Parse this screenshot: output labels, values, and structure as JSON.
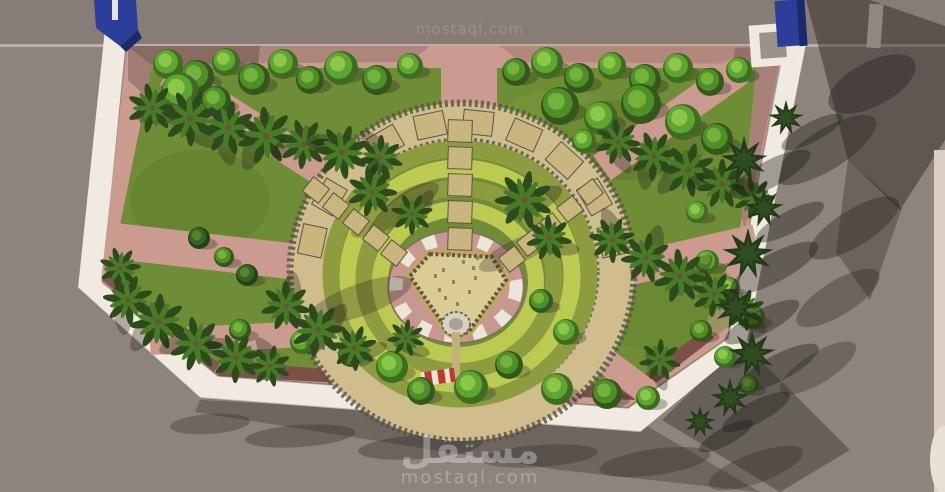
{
  "watermark": {
    "top": "mostaql.com",
    "logo_ar": "مستقل",
    "url": "mostaql.com"
  },
  "palette": {
    "street": "#8e847d",
    "streetTop": "#887d76",
    "shadow": "#27221e",
    "wall": "#f0eae2",
    "wallShade": "#d9d1c6",
    "paving": "#cb9b8f",
    "pavingShade": "#b2857c",
    "maroon": "#7c5047",
    "lawn": "#6f8c36",
    "lawnShade": "#5a7629",
    "ringTan": "#cfbd8e",
    "pebble": "#56504a",
    "grassLight": "#bcca52",
    "grassOlive": "#8c9c3e",
    "plaza": "#c69890",
    "checker": "#ece5da",
    "shield": "#dbcc96",
    "shieldGold": "#c3a65c",
    "shieldDark": "#5f564a",
    "paver": "#c9b67e",
    "paverEdge": "#5b5348",
    "fountain": "#d8d2c6",
    "tanPath": "#c4b07a",
    "blue": "#2c3e99",
    "blueDark": "#1d2a6a",
    "cream": "#d9cec1",
    "creamLight": "#e9e1d5",
    "red": "#c0392b",
    "white": "#ffffff",
    "palmDark": "#2c4a1b",
    "palmLight": "#4a7a26",
    "palmTrunk": "#6b5436",
    "conifer": "#233a1a",
    "coniferLight": "#2f4d20"
  },
  "scene": {
    "center": {
      "x": 462,
      "y": 272
    },
    "treeColors": [
      [
        "#3f6b22",
        "#5ea62f",
        "#8cc74b"
      ],
      [
        "#35571d",
        "#4f8f28",
        "#74b23c"
      ],
      [
        "#24411c",
        "#38631f",
        "#52862c"
      ]
    ],
    "trees": [
      [
        168,
        64,
        15,
        0
      ],
      [
        197,
        77,
        17,
        1
      ],
      [
        226,
        62,
        14,
        0
      ],
      [
        254,
        79,
        16,
        1
      ],
      [
        283,
        64,
        15,
        0
      ],
      [
        310,
        80,
        14,
        1
      ],
      [
        341,
        68,
        17,
        0
      ],
      [
        377,
        80,
        15,
        1
      ],
      [
        410,
        66,
        13,
        0
      ],
      [
        516,
        72,
        14,
        1
      ],
      [
        547,
        63,
        16,
        0
      ],
      [
        579,
        78,
        15,
        1
      ],
      [
        612,
        66,
        14,
        0
      ],
      [
        645,
        80,
        16,
        1
      ],
      [
        678,
        68,
        15,
        0
      ],
      [
        710,
        82,
        14,
        1
      ],
      [
        739,
        70,
        13,
        0
      ],
      [
        180,
        92,
        19,
        0
      ],
      [
        216,
        101,
        15,
        1
      ],
      [
        560,
        106,
        19,
        1
      ],
      [
        601,
        118,
        17,
        0
      ],
      [
        641,
        104,
        20,
        1
      ],
      [
        683,
        122,
        18,
        0
      ],
      [
        717,
        139,
        16,
        1
      ],
      [
        584,
        141,
        12,
        0
      ],
      [
        199,
        238,
        11,
        2
      ],
      [
        224,
        257,
        10,
        1
      ],
      [
        247,
        275,
        11,
        2
      ],
      [
        697,
        212,
        11,
        0
      ],
      [
        707,
        262,
        12,
        0
      ],
      [
        729,
        288,
        11,
        0
      ],
      [
        753,
        317,
        12,
        0
      ],
      [
        701,
        331,
        11,
        1
      ],
      [
        725,
        357,
        11,
        0
      ],
      [
        749,
        385,
        10,
        1
      ],
      [
        240,
        330,
        11,
        1
      ],
      [
        302,
        342,
        12,
        0
      ],
      [
        351,
        354,
        13,
        1
      ],
      [
        392,
        367,
        16,
        0
      ],
      [
        421,
        391,
        14,
        1
      ],
      [
        471,
        387,
        17,
        0
      ],
      [
        509,
        365,
        14,
        1
      ],
      [
        557,
        389,
        16,
        0
      ],
      [
        607,
        394,
        15,
        1
      ],
      [
        648,
        398,
        12,
        0
      ],
      [
        541,
        301,
        12,
        1
      ],
      [
        566,
        332,
        13,
        0
      ]
    ],
    "palms": [
      [
        152,
        108,
        24
      ],
      [
        190,
        118,
        27
      ],
      [
        228,
        128,
        26
      ],
      [
        266,
        136,
        28
      ],
      [
        304,
        144,
        24
      ],
      [
        342,
        152,
        26
      ],
      [
        380,
        158,
        22
      ],
      [
        372,
        192,
        24
      ],
      [
        412,
        214,
        20
      ],
      [
        524,
        200,
        28
      ],
      [
        549,
        238,
        22
      ],
      [
        120,
        268,
        20
      ],
      [
        128,
        300,
        24
      ],
      [
        158,
        322,
        27
      ],
      [
        196,
        344,
        26
      ],
      [
        236,
        358,
        24
      ],
      [
        270,
        366,
        20
      ],
      [
        286,
        306,
        24
      ],
      [
        318,
        330,
        26
      ],
      [
        354,
        348,
        22
      ],
      [
        406,
        338,
        18
      ],
      [
        618,
        142,
        22
      ],
      [
        654,
        156,
        24
      ],
      [
        688,
        170,
        26
      ],
      [
        722,
        184,
        24
      ],
      [
        754,
        198,
        20
      ],
      [
        612,
        240,
        22
      ],
      [
        646,
        258,
        24
      ],
      [
        680,
        276,
        26
      ],
      [
        714,
        294,
        22
      ],
      [
        744,
        310,
        20
      ],
      [
        660,
        360,
        20
      ]
    ],
    "conifers": [
      [
        744,
        160,
        24
      ],
      [
        764,
        208,
        20
      ],
      [
        748,
        254,
        26
      ],
      [
        736,
        308,
        22
      ],
      [
        752,
        354,
        24
      ],
      [
        730,
        398,
        20
      ],
      [
        700,
        422,
        16
      ],
      [
        786,
        118,
        18
      ]
    ],
    "ringStones": {
      "radius": 153,
      "radiusY": 150,
      "angles": [
        -78,
        -60,
        -30,
        -12,
        6,
        24,
        42,
        60,
        78
      ]
    },
    "columnStones": {
      "x": 448,
      "w": 24,
      "h": 22,
      "ys": [
        120,
        147,
        174,
        201,
        228
      ]
    },
    "diagStonesRight": {
      "rot": -38,
      "pts": [
        [
          590,
          192
        ],
        [
          570,
          209
        ],
        [
          550,
          226
        ],
        [
          530,
          243
        ],
        [
          512,
          259
        ]
      ]
    },
    "diagStonesLeft": {
      "rot": 38,
      "pts": [
        [
          316,
          190
        ],
        [
          336,
          206
        ],
        [
          356,
          222
        ],
        [
          376,
          238
        ],
        [
          394,
          253
        ]
      ]
    },
    "speckles": [
      [
        -16,
        -20
      ],
      [
        4,
        -28
      ],
      [
        16,
        -12
      ],
      [
        -6,
        -8
      ],
      [
        10,
        2
      ],
      [
        -20,
        0
      ],
      [
        -2,
        14
      ],
      [
        6,
        -44
      ],
      [
        -10,
        -36
      ],
      [
        18,
        -32
      ],
      [
        -24,
        -14
      ],
      [
        2,
        26
      ],
      [
        14,
        -22
      ],
      [
        -14,
        8
      ]
    ],
    "streetShadows": [
      [
        826,
        150,
        58,
        20,
        -32,
        0.4
      ],
      [
        854,
        228,
        52,
        18,
        -32,
        0.38
      ],
      [
        838,
        298,
        48,
        17,
        -32,
        0.33
      ],
      [
        818,
        368,
        44,
        15,
        -32,
        0.3
      ],
      [
        872,
        84,
        48,
        22,
        -28,
        0.42
      ],
      [
        210,
        424,
        40,
        10,
        -4,
        0.3
      ],
      [
        300,
        436,
        55,
        11,
        -4,
        0.32
      ],
      [
        420,
        447,
        62,
        12,
        -4,
        0.33
      ],
      [
        540,
        456,
        58,
        11,
        -4,
        0.3
      ],
      [
        655,
        462,
        56,
        13,
        -8,
        0.32
      ],
      [
        756,
        468,
        50,
        15,
        -20,
        0.3
      ]
    ]
  }
}
